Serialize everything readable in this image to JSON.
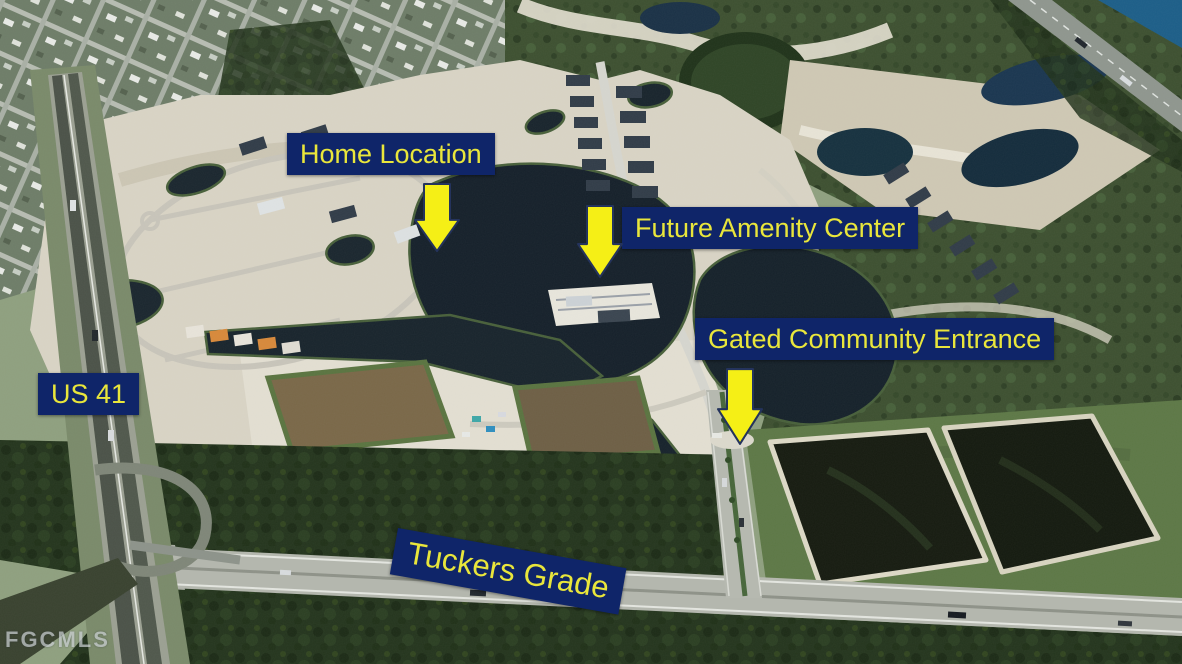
{
  "annotations": {
    "home_location": "Home Location",
    "future_amenity_center": "Future Amenity Center",
    "gated_community_entrance": "Gated Community Entrance",
    "us_41": "US 41",
    "tuckers_grade": "Tuckers Grade"
  },
  "watermark": "FGCMLS",
  "colors": {
    "label_background": "#0f2569",
    "label_text": "#e9e63b",
    "arrow_fill": "#f5ef16",
    "arrow_outline": "#24335c",
    "watermark_text": "#c9ced2"
  }
}
